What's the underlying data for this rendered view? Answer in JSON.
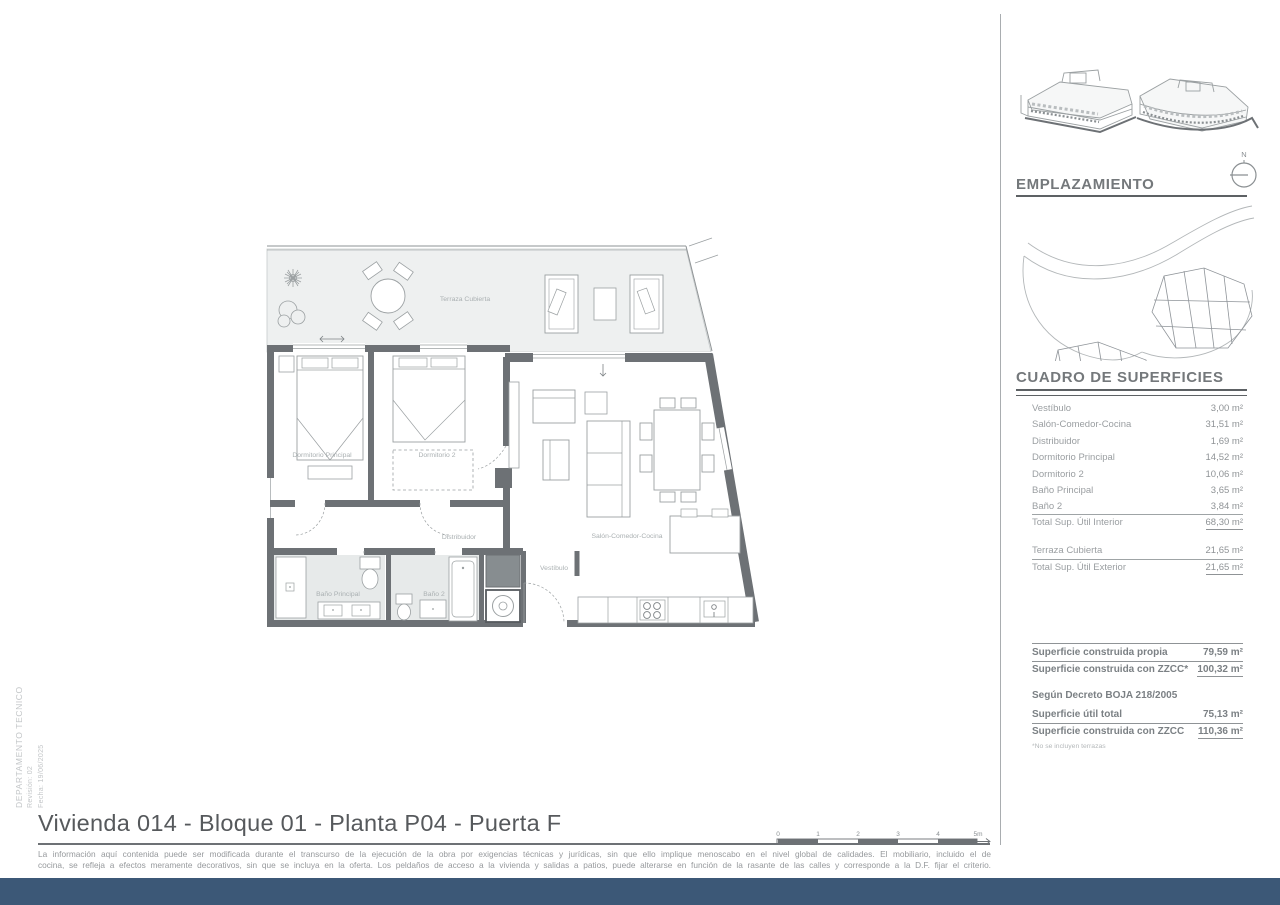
{
  "meta": {
    "department": "DEPARTAMENTO TECNICO",
    "revision": "Revisión: 02",
    "date": "Fecha: 19/06/2025"
  },
  "plan_labels": {
    "terraza": "Terraza Cubierta",
    "dormitorio_principal": "Dormitorio Principal",
    "dormitorio_2": "Dormitorio 2",
    "distribuidor": "Distribuidor",
    "salon": "Salón-Comedor-Cocina",
    "bano_principal": "Baño Principal",
    "bano_2": "Baño 2",
    "vestibulo": "Vestíbulo"
  },
  "emplazamiento": {
    "title": "EMPLAZAMIENTO",
    "north": "N"
  },
  "surfaces": {
    "title": "CUADRO DE SUPERFICIES",
    "interior_rows": [
      {
        "label": "Vestíbulo",
        "value": "3,00 m²"
      },
      {
        "label": "Salón-Comedor-Cocina",
        "value": "31,51 m²"
      },
      {
        "label": "Distribuidor",
        "value": "1,69 m²"
      },
      {
        "label": "Dormitorio Principal",
        "value": "14,52 m²"
      },
      {
        "label": "Dormitorio 2",
        "value": "10,06 m²"
      },
      {
        "label": "Baño Principal",
        "value": "3,65 m²"
      },
      {
        "label": "Baño 2",
        "value": "3,84 m²"
      }
    ],
    "total_interior": {
      "label": "Total Sup. Útil Interior",
      "value": "68,30 m²"
    },
    "exterior_rows": [
      {
        "label": "Terraza Cubierta",
        "value": "21,65 m²"
      }
    ],
    "total_exterior": {
      "label": "Total Sup. Útil Exterior",
      "value": "21,65 m²"
    },
    "built_rows": [
      {
        "label": "Superficie construida propia",
        "value": "79,59 m²"
      },
      {
        "label": "Superficie construida con ZZCC*",
        "value": "100,32 m²"
      }
    ],
    "decree_title": "Según Decreto BOJA 218/2005",
    "decree_rows": [
      {
        "label": "Superficie útil total",
        "value": "75,13 m²"
      },
      {
        "label": "Superficie construida con ZZCC",
        "value": "110,36 m²"
      }
    ],
    "footnote": "*No se incluyen terrazas"
  },
  "footer": {
    "title": "Vivienda 014 - Bloque 01 - Planta P04 - Puerta F",
    "disclaimer_1": "La información aquí contenida puede ser modificada durante el transcurso de la ejecución de la obra por exigencias técnicas y jurídicas, sin que ello implique menoscabo en el nivel global de calidades. El mobiliario, incluido el de",
    "disclaimer_2": "cocina, se refleja a efectos meramente decorativos, sin que se incluya en la oferta. Los peldaños de acceso a la vivienda y salidas a patios, puede alterarse en función de la rasante de las calles y corresponde a la D.F. fijar el criterio."
  },
  "scale_bar": {
    "ticks": [
      "0",
      "1",
      "2",
      "3",
      "4",
      "5m"
    ]
  },
  "colors": {
    "footer_bar": "#3c5877",
    "highlight_unit": "#3e5b7c",
    "wall": "#6d7175"
  }
}
